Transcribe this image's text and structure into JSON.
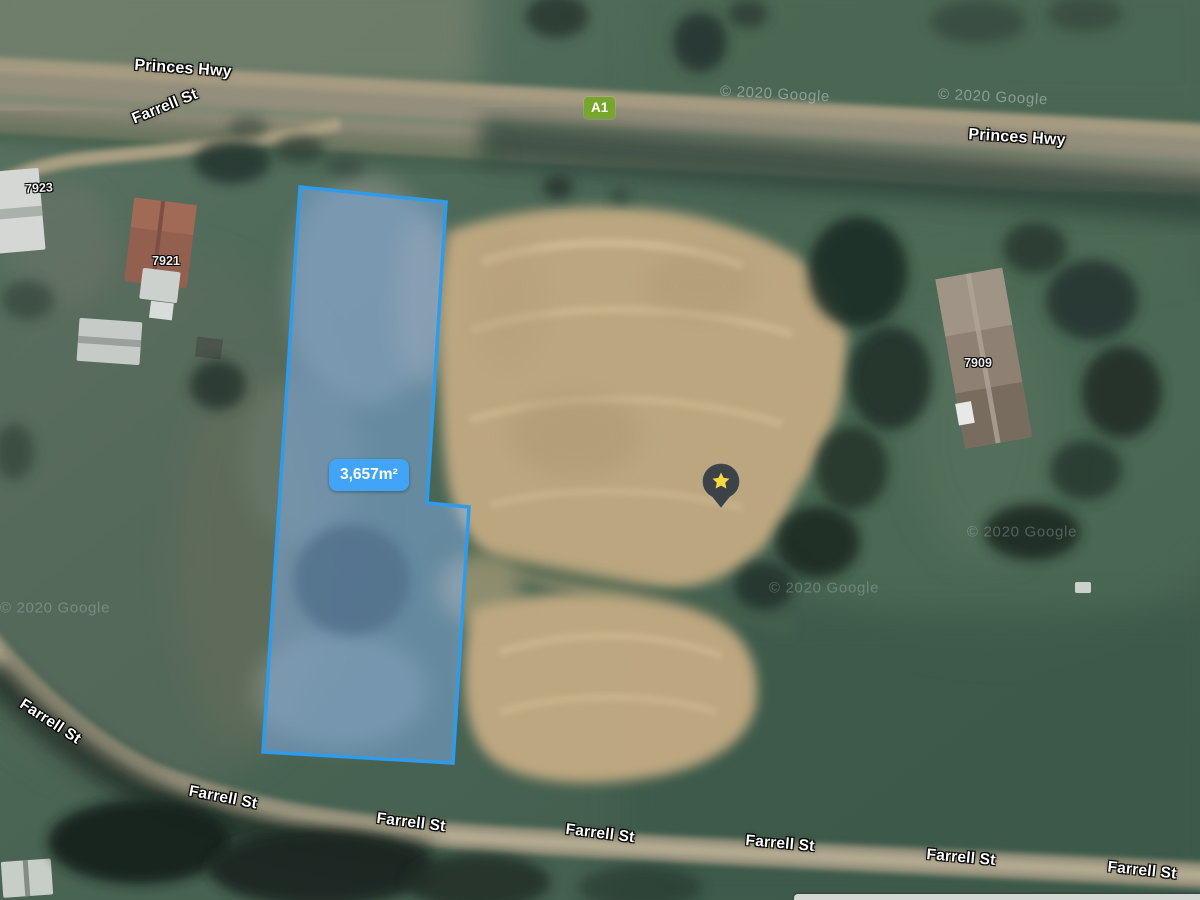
{
  "roads": {
    "princes_hwy": "Princes Hwy",
    "farrell_st": "Farrell St",
    "route_badge": "A1",
    "route_badge_color": "#77a62c"
  },
  "parcel": {
    "area_label": "3,657m²",
    "outline_color": "#2e9ceb",
    "fill_color": "rgba(130,175,235,0.5)",
    "badge_color": "#41a4f6"
  },
  "addresses": {
    "n7923": "7923",
    "n7921": "7921",
    "n7909": "7909"
  },
  "marker": {
    "icon": "star-icon",
    "body_color": "#3c4246",
    "star_color": "#f7da3f"
  },
  "attribution": {
    "text": "© 2020 Google"
  }
}
